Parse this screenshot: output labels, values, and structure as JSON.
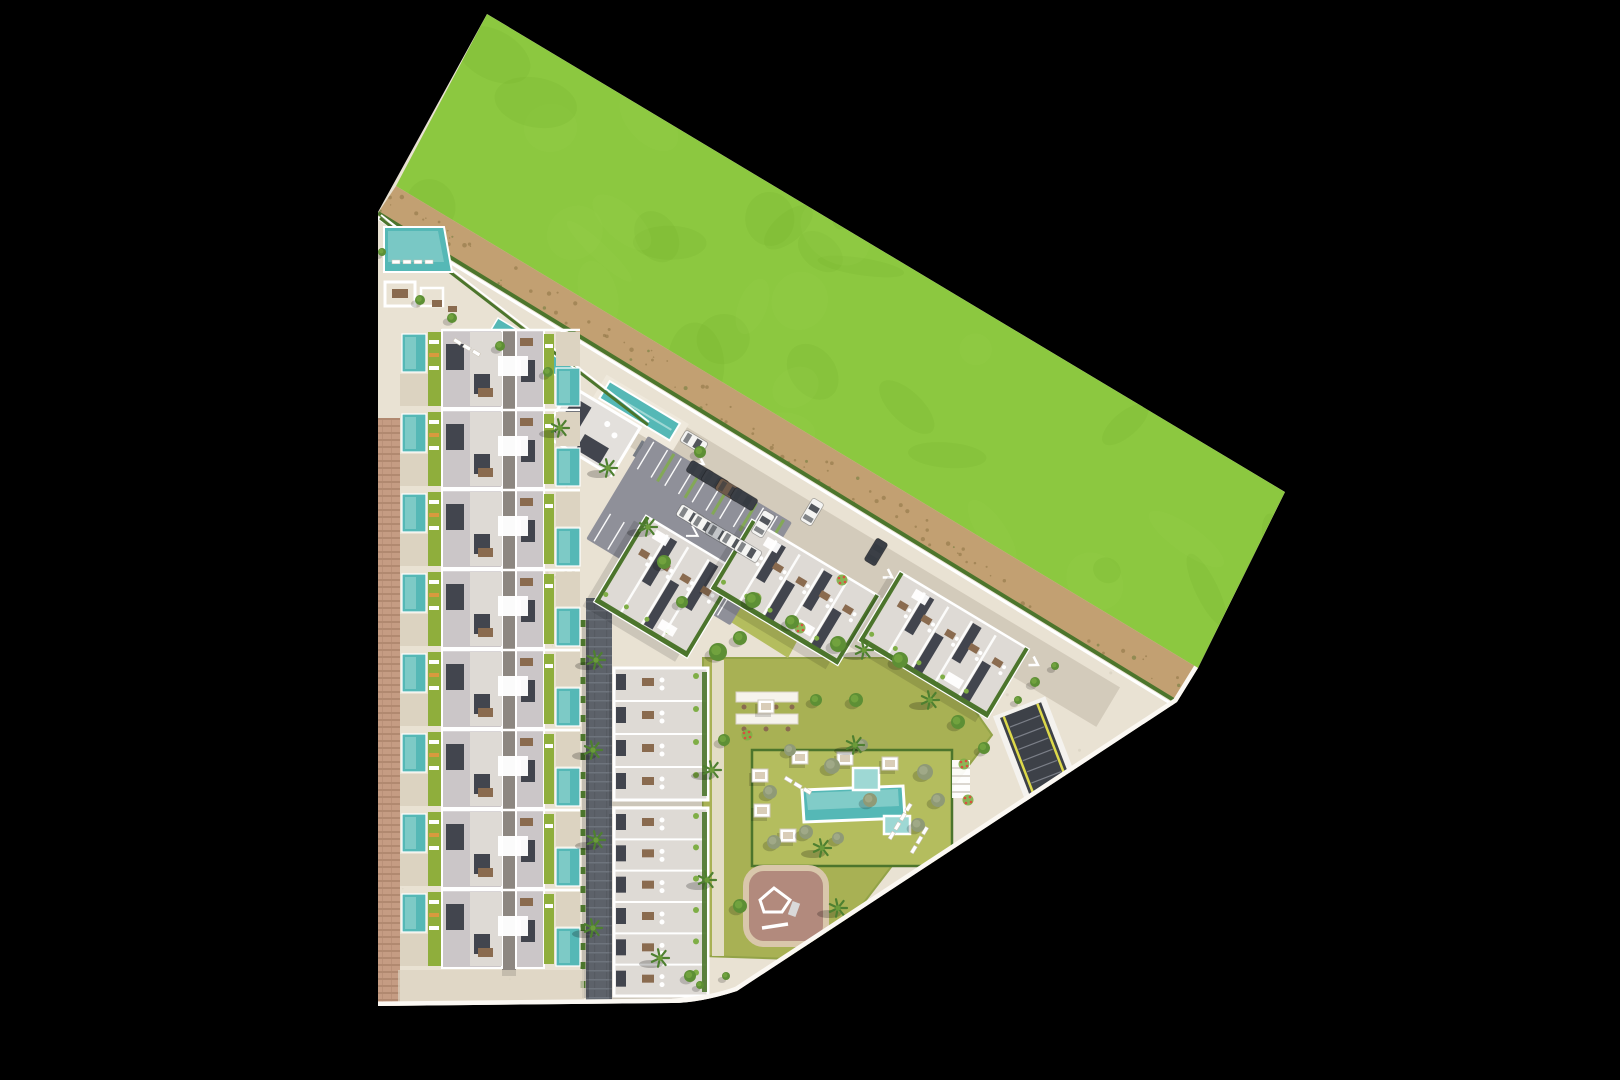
{
  "title": "residential-development-site-plan",
  "colors": {
    "green_base": "#8cc840",
    "green_dark": "#77b22d",
    "green_light": "#9dd453",
    "dirt": "#c2a072",
    "dirt_dark": "#8d7244",
    "dirt_green": "#6b7a3a",
    "pav": "#e9e2d3",
    "pav2": "#dcd3c1",
    "brick": "#c59c83",
    "road": "#d3cbbb",
    "street": "#5d626a",
    "street_line": "#6e747d",
    "asphalt": "#8f9099",
    "roof": "#cbc6c8",
    "roof2": "#dedad5",
    "dark": "#42454e",
    "white": "#ffffff",
    "curb": "#fbf8f3",
    "pool": "#55b8b6",
    "pool_light": "#9ed8d4",
    "lime": "#8fae3c",
    "lime2": "#7fae46",
    "lawn": "#a8b154",
    "lawn_light": "#b4bd5e",
    "hedge": "#4c752c",
    "playground": "#b28a7d",
    "playground_border": "#d9c7ab",
    "ramp": "#3d4148",
    "ramp_yellow": "#ddd94a",
    "table": "#8a6b4f",
    "spine": "#8d8781",
    "lounge_orange": "#d89a3e",
    "car_white": "#f5f5f3",
    "car_dark": "#3b3f46",
    "car_silver": "#c3c6c9",
    "car_brown": "#6e5a4a",
    "tree_dark": "#5d8f35",
    "tree_mid": "#74a63f",
    "tree_gray": "#8f9a76",
    "palm": "#4e8030",
    "palm_mid": "#6b9b3a",
    "flower_red": "#d94f3f"
  },
  "townhouses": {
    "units": 8,
    "start_y": 330,
    "pitch": 80
  },
  "middle_blocks": [
    {
      "x": 614,
      "y": 668,
      "w": 94,
      "h": 132,
      "bays": 4
    },
    {
      "x": 614,
      "y": 808,
      "w": 94,
      "h": 188,
      "bays": 6
    }
  ],
  "diagonal_blocks": [
    {
      "x": 646,
      "y": 516,
      "len": 108,
      "wid": 100,
      "stripes": 3
    },
    {
      "x": 752,
      "y": 520,
      "len": 148,
      "wid": 80,
      "stripes": 4
    },
    {
      "x": 900,
      "y": 572,
      "len": 150,
      "wid": 80,
      "stripes": 4
    }
  ],
  "parking": {
    "bays_per_row": 10,
    "rows": 2
  },
  "cars": [
    {
      "x": 700,
      "y": 472,
      "r": 121,
      "c": "car_dark"
    },
    {
      "x": 715,
      "y": 481,
      "r": 121,
      "c": "car_dark"
    },
    {
      "x": 729,
      "y": 490,
      "r": 121,
      "c": "car_brown"
    },
    {
      "x": 744,
      "y": 499,
      "r": 121,
      "c": "car_dark"
    },
    {
      "x": 690,
      "y": 516,
      "r": 121,
      "c": "car_white"
    },
    {
      "x": 704,
      "y": 525,
      "r": 121,
      "c": "car_white"
    },
    {
      "x": 719,
      "y": 534,
      "r": 121,
      "c": "car_silver"
    },
    {
      "x": 733,
      "y": 542,
      "r": 121,
      "c": "car_white"
    },
    {
      "x": 748,
      "y": 551,
      "r": 121,
      "c": "car_white"
    },
    {
      "x": 763,
      "y": 524,
      "r": 31,
      "c": "car_white"
    },
    {
      "x": 812,
      "y": 512,
      "r": 31,
      "c": "car_white"
    },
    {
      "x": 876,
      "y": 552,
      "r": 31,
      "c": "car_dark"
    },
    {
      "x": 694,
      "y": 442,
      "r": 121,
      "c": "car_white"
    }
  ],
  "palms": [
    [
      596,
      660
    ],
    [
      593,
      750
    ],
    [
      596,
      840
    ],
    [
      593,
      928
    ],
    [
      660,
      958
    ],
    [
      608,
      468
    ],
    [
      648,
      527
    ],
    [
      712,
      770
    ],
    [
      707,
      880
    ],
    [
      838,
      908
    ],
    [
      930,
      700
    ],
    [
      864,
      650
    ],
    [
      560,
      428
    ],
    [
      822,
      848
    ],
    [
      855,
      745
    ]
  ],
  "round_trees": [
    [
      718,
      652,
      9
    ],
    [
      740,
      638,
      7
    ],
    [
      838,
      644,
      8
    ],
    [
      900,
      660,
      8
    ],
    [
      958,
      722,
      7
    ],
    [
      984,
      748,
      6
    ],
    [
      753,
      600,
      8
    ],
    [
      792,
      622,
      7
    ],
    [
      664,
      562,
      7
    ],
    [
      682,
      602,
      6
    ],
    [
      700,
      452,
      6
    ],
    [
      740,
      906,
      7
    ],
    [
      832,
      932,
      6
    ],
    [
      690,
      976,
      6
    ],
    [
      856,
      700,
      7
    ],
    [
      816,
      700,
      6
    ],
    [
      724,
      740,
      6
    ],
    [
      905,
      908,
      6
    ],
    [
      868,
      922,
      6
    ],
    [
      452,
      318,
      5
    ],
    [
      420,
      300,
      5
    ],
    [
      382,
      252,
      4
    ],
    [
      500,
      346,
      5
    ],
    [
      548,
      372,
      5
    ],
    [
      1035,
      682,
      5
    ],
    [
      1055,
      666,
      4
    ],
    [
      1018,
      700,
      4
    ],
    [
      700,
      985,
      4
    ],
    [
      726,
      976,
      4
    ]
  ],
  "gray_trees": [
    [
      832,
      766,
      8
    ],
    [
      870,
      800,
      7
    ],
    [
      806,
      832,
      7
    ],
    [
      838,
      838,
      6
    ],
    [
      790,
      750,
      6
    ],
    [
      925,
      772,
      8
    ],
    [
      938,
      800,
      7
    ],
    [
      918,
      825,
      7
    ],
    [
      862,
      745,
      6
    ],
    [
      774,
      842,
      7
    ],
    [
      770,
      792,
      7
    ]
  ],
  "cabanas": [
    [
      800,
      757
    ],
    [
      845,
      758
    ],
    [
      890,
      763
    ],
    [
      788,
      835
    ],
    [
      760,
      775
    ],
    [
      762,
      810
    ],
    [
      766,
      706
    ]
  ],
  "flowers": [
    [
      756,
      598
    ],
    [
      800,
      628
    ],
    [
      964,
      764
    ],
    [
      968,
      800
    ],
    [
      747,
      735
    ],
    [
      842,
      580
    ]
  ],
  "lounger_rows": [
    {
      "x": 888,
      "y": 838,
      "n": 4,
      "rot": -59
    },
    {
      "x": 910,
      "y": 852,
      "n": 3,
      "rot": -59
    },
    {
      "x": 786,
      "y": 776,
      "n": 3,
      "rot": 31
    },
    {
      "x": 392,
      "y": 260,
      "n": 4,
      "rot": 0
    },
    {
      "x": 455,
      "y": 338,
      "n": 3,
      "rot": 31
    }
  ],
  "texture_counts": {
    "grass_blobs": 80,
    "dirt_specks": 120,
    "pavement_specks": 140
  }
}
